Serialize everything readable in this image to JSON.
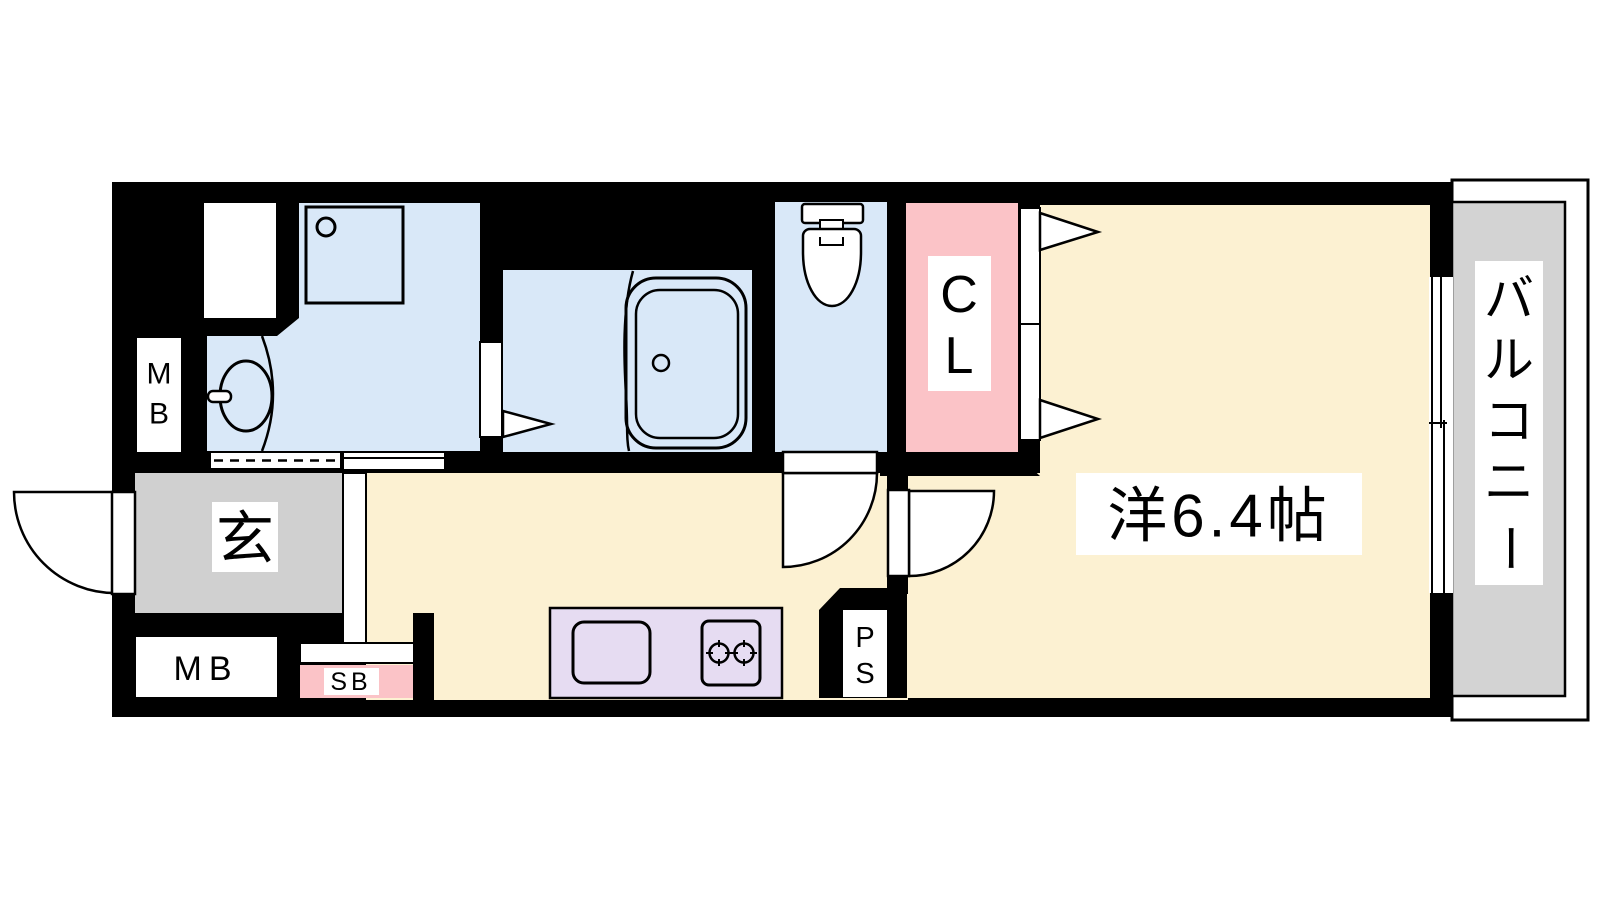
{
  "plan": {
    "title": "1K apartment floor plan",
    "labels": {
      "entrance": "玄",
      "meter_box_side": [
        "M",
        "B"
      ],
      "meter_box_bottom": "MB",
      "shoe_box": "SB",
      "pipe_space": [
        "P",
        "S"
      ],
      "closet": [
        "C",
        "L"
      ],
      "western_room": "洋6.4帖",
      "balcony": [
        "バ",
        "ル",
        "コ",
        "ニ",
        "ー"
      ]
    },
    "colors": {
      "wall": "#000000",
      "wet_area_floor": "#d9e8f8",
      "room_floor": "#fcf1d2",
      "closet_fill": "#fbc3c7",
      "shoe_box_fill": "#fbc3c7",
      "kitchen_counter_fill": "#e6dcf2",
      "entrance_floor": "#d0d0d0",
      "balcony_floor": "#d3d3d3",
      "fixture_line": "#000000",
      "label_background": "#ffffff"
    }
  }
}
